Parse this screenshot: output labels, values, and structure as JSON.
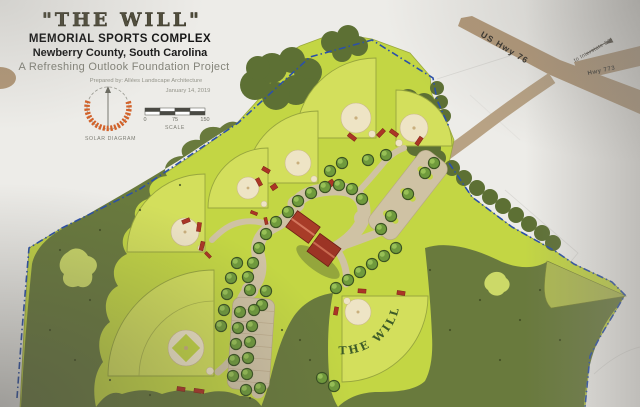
{
  "title_block": {
    "title": "\"THE WILL\"",
    "subtitle": "MEMORIAL SPORTS COMPLEX",
    "location": "Newberry County, South Carolina",
    "project": "A Refreshing Outlook Foundation Project",
    "prepared_by": "Prepared by: Allées Landscape Architecture",
    "date": "January 14, 2019"
  },
  "legend": {
    "solar_label": "SOLAR DIAGRAM",
    "scale_label": "SCALE",
    "scale_ticks": [
      "0",
      "75",
      "150"
    ]
  },
  "roads": {
    "us_hwy_76": "US Hwy 76",
    "to_interstate": "to Interstate 26",
    "hwy_773": "Hwy 773"
  },
  "site": {
    "field_label": "THE WILL"
  },
  "colors": {
    "paper": "#ecebe7",
    "lawn": "#c3d644",
    "field": "#d3df5c",
    "forest": "#697a3d",
    "tree": "#6f9a3c",
    "road": "#b29878",
    "path": "#cfc2a4",
    "infield": "#eee4c5",
    "building_red": "#a83c28",
    "boundary_blue": "#2b50a8",
    "sun_orange": "#d2622a"
  }
}
